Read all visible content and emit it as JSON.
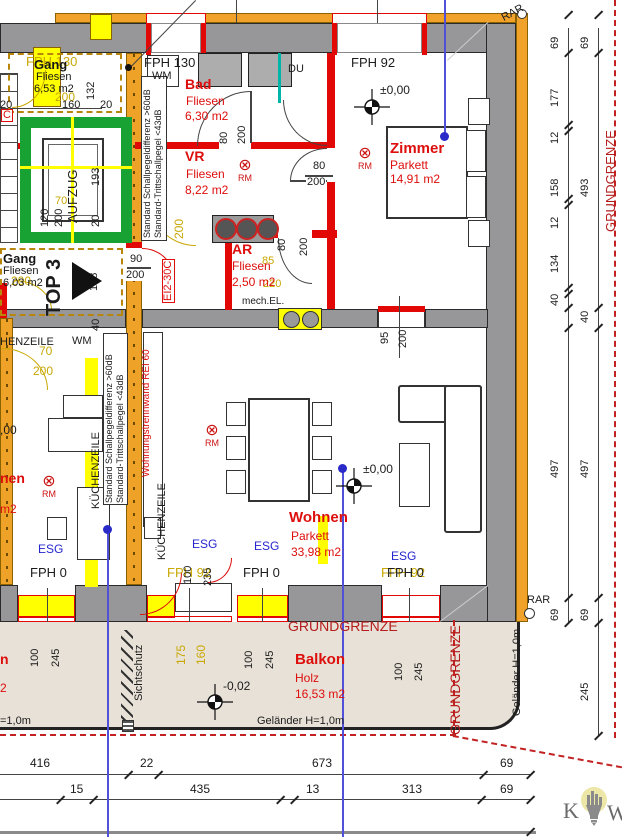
{
  "colors": {
    "wall_gray": "#97979a",
    "insulation_orange": "#f0a22a",
    "highlight_yellow": "#ffff00",
    "wall_red": "#e20806",
    "room_text_red": "#dd0e0c",
    "dim_yellow": "#c9a804",
    "glass_blue": "#2626cf",
    "axis_blue": "#5050d8",
    "elevator_green": "#17a233",
    "balcony_beige": "#e8e1d7",
    "boundary_red": "#b51d1d"
  },
  "rooms": [
    {
      "name": "Gang",
      "finish": "Fliesen",
      "area": "6,53 m2"
    },
    {
      "name": "Bad",
      "finish": "Fliesen",
      "area": "6,30 m2"
    },
    {
      "name": "VR",
      "finish": "Fliesen",
      "area": "8,22 m2"
    },
    {
      "name": "Gang",
      "finish": "Fliesen",
      "area": "6,03 m2"
    },
    {
      "name": "AR",
      "finish": "Fliesen",
      "area": "2,50 m2"
    },
    {
      "name": "Zimmer",
      "finish": "Parkett",
      "area": "14,91 m2"
    },
    {
      "name": "Wohnen",
      "finish": "Parkett",
      "area": "33,98 m2"
    },
    {
      "name": "Balkon",
      "finish": "Holz",
      "area": "16,53 m2"
    }
  ],
  "rm": {
    "symbol": "⊗",
    "label": "RM"
  },
  "logo": {
    "left": "K",
    "right": "W"
  },
  "annotations": [
    {
      "t": "FPH 130",
      "x": 26,
      "y": 55,
      "fs": 13,
      "c": "c-yel",
      "n": "fph-label"
    },
    {
      "t": "FPH 92",
      "x": 167,
      "y": 566,
      "fs": 13,
      "c": "c-yel",
      "n": "fph-label"
    },
    {
      "t": "FPH 92",
      "x": 381,
      "y": 566,
      "fs": 13,
      "c": "c-yel",
      "n": "fph-label"
    },
    {
      "t": "200",
      "x": 55,
      "y": 91,
      "fs": 12,
      "c": "c-yel",
      "n": "dim"
    },
    {
      "t": "200",
      "x": 11,
      "y": 275,
      "fs": 12,
      "c": "c-yel",
      "n": "dim"
    },
    {
      "t": "70",
      "x": 39,
      "y": 345,
      "fs": 12,
      "c": "c-yel",
      "n": "dim"
    },
    {
      "t": "200",
      "x": 33,
      "y": 365,
      "fs": 12,
      "c": "c-yel",
      "n": "dim"
    },
    {
      "t": "200",
      "x": 173,
      "y": 239,
      "fs": 12,
      "r": -90,
      "c": "c-yel",
      "n": "dim"
    },
    {
      "t": "85",
      "x": 262,
      "y": 256,
      "fs": 11,
      "c": "c-yel",
      "n": "dim"
    },
    {
      "t": "220",
      "x": 263,
      "y": 279,
      "fs": 11,
      "c": "c-yel",
      "n": "dim"
    },
    {
      "t": "175",
      "x": 175,
      "y": 665,
      "fs": 12,
      "r": -90,
      "c": "c-yel",
      "n": "dim"
    },
    {
      "t": "160",
      "x": 195,
      "y": 665,
      "fs": 12,
      "r": -90,
      "c": "c-yel",
      "n": "dim"
    },
    {
      "t": "70",
      "x": 55,
      "y": 196,
      "fs": 11,
      "c": "c-yel",
      "n": "dim"
    },
    {
      "t": "FPH 130",
      "x": 144,
      "y": 56,
      "fs": 13,
      "n": "fph-label"
    },
    {
      "t": "WM",
      "x": 152,
      "y": 71,
      "fs": 11,
      "n": "washing-machine-label"
    },
    {
      "t": "FPH 92",
      "x": 351,
      "y": 56,
      "fs": 13,
      "n": "fph-label"
    },
    {
      "t": "DU",
      "x": 288,
      "y": 64,
      "fs": 11,
      "n": "shower-label"
    },
    {
      "t": "mech.EL.",
      "x": 242,
      "y": 297,
      "fs": 10,
      "n": "mech-vent-label"
    },
    {
      "t": "WM",
      "x": 72,
      "y": 336,
      "fs": 11,
      "n": "washing-machine-label"
    },
    {
      "t": "HENZEILE",
      "x": 0,
      "y": 337,
      "fs": 11,
      "n": "kitchen-label"
    },
    {
      "t": "KÜCHENZEILE",
      "x": 91,
      "y": 509,
      "fs": 11,
      "r": -90,
      "n": "kitchen-label"
    },
    {
      "t": "KÜCHENZEILE",
      "x": 157,
      "y": 560,
      "fs": 11,
      "r": -90,
      "n": "kitchen-label"
    },
    {
      "t": "AUFZUG",
      "x": 66,
      "y": 223,
      "fs": 13,
      "r": -90,
      "n": "elevator-label"
    },
    {
      "t": "TOP 3",
      "x": 44,
      "y": 316,
      "fs": 20,
      "r": -90,
      "b": 1,
      "n": "unit-number-label"
    },
    {
      "t": "Sichtschutz",
      "x": 134,
      "y": 701,
      "fs": 11,
      "r": -90,
      "n": "privacy-screen-label"
    },
    {
      "t": "Geländer H=1,0m",
      "x": 257,
      "y": 716,
      "fs": 11,
      "n": "railing-label"
    },
    {
      "t": "=1,0m",
      "x": 0,
      "y": 716,
      "fs": 11,
      "n": "railing-label"
    },
    {
      "t": "Geländer H=1,0m",
      "x": 512,
      "y": 716,
      "fs": 11,
      "r": -90,
      "n": "railing-label"
    },
    {
      "t": "RAR",
      "x": 500,
      "y": 14,
      "fs": 11,
      "r": -28,
      "n": "rar-label"
    },
    {
      "t": "RAR",
      "x": 527,
      "y": 595,
      "fs": 11,
      "n": "rar-label"
    },
    {
      "t": "FPH 0",
      "x": 30,
      "y": 566,
      "fs": 13,
      "n": "fph-label"
    },
    {
      "t": "FPH 0",
      "x": 243,
      "y": 566,
      "fs": 13,
      "n": "fph-label"
    },
    {
      "t": "FPH 0",
      "x": 387,
      "y": 566,
      "fs": 13,
      "n": "fph-label"
    },
    {
      "t": "±0,00",
      "x": 380,
      "y": 84,
      "fs": 12,
      "n": "level-label"
    },
    {
      "t": "±0,00",
      "x": 363,
      "y": 463,
      "fs": 12,
      "n": "level-label"
    },
    {
      "t": ",00",
      "x": 0,
      "y": 424,
      "fs": 12,
      "n": "level-label"
    },
    {
      "t": "-0,02",
      "x": 223,
      "y": 680,
      "fs": 12,
      "n": "level-label"
    },
    {
      "t": "GRUNDGRENZE",
      "x": 288,
      "y": 619,
      "fs": 14,
      "c": "c-dred",
      "n": "property-line-label"
    },
    {
      "t": "GRUNDGRENZE",
      "x": 448,
      "y": 735,
      "fs": 14,
      "r": -90,
      "c": "c-dred",
      "n": "property-line-label"
    },
    {
      "t": "GRUNDGRENZE",
      "x": 604,
      "y": 232,
      "fs": 13,
      "r": -90,
      "c": "c-dred",
      "n": "property-line-label"
    },
    {
      "t": "EI2-30C",
      "x": 162,
      "y": 303,
      "fs": 11,
      "r": -90,
      "c": "c-red box",
      "n": "fire-door-label"
    },
    {
      "t": "C",
      "x": 1,
      "y": 109,
      "fs": 11,
      "c": "c-red box",
      "n": "fire-door-label"
    },
    {
      "t": "Wohnungstrennwand REI 60",
      "x": 142,
      "y": 477,
      "fs": 10,
      "r": -90,
      "c": "c-red",
      "n": "party-wall-label"
    },
    {
      "t": "nen",
      "x": 0,
      "y": 471,
      "fs": 14,
      "b": 1,
      "c": "c-red",
      "n": "room-label-partial"
    },
    {
      "t": "m2",
      "x": 0,
      "y": 503,
      "fs": 12,
      "c": "c-red",
      "n": "room-label-partial"
    },
    {
      "t": "n",
      "x": 0,
      "y": 652,
      "fs": 14,
      "b": 1,
      "c": "c-red",
      "n": "room-label-partial"
    },
    {
      "t": "2",
      "x": 0,
      "y": 682,
      "fs": 12,
      "c": "c-red",
      "n": "room-label-partial"
    },
    {
      "t": "Standard Schallpegeldifferenz >60dB",
      "x": 143,
      "y": 238,
      "fs": 9,
      "r": -90,
      "n": "sound-insulation-note"
    },
    {
      "t": "Standard-Trittschallpegel <43dB",
      "x": 154,
      "y": 238,
      "fs": 9,
      "r": -90,
      "n": "sound-insulation-note"
    },
    {
      "t": "Standard Schallpegeldifferenz >60dB",
      "x": 105,
      "y": 503,
      "fs": 9,
      "r": -90,
      "n": "sound-insulation-note"
    },
    {
      "t": "Standard-Trittschallpegel <43dB",
      "x": 116,
      "y": 503,
      "fs": 9,
      "r": -90,
      "n": "sound-insulation-note"
    },
    {
      "t": "ESG",
      "x": 192,
      "y": 538,
      "fs": 12,
      "c": "c-blu",
      "n": "glass-label"
    },
    {
      "t": "ESG",
      "x": 254,
      "y": 540,
      "fs": 12,
      "c": "c-blu",
      "n": "glass-label"
    },
    {
      "t": "ESG",
      "x": 391,
      "y": 550,
      "fs": 12,
      "c": "c-blu",
      "n": "glass-label"
    },
    {
      "t": "ESG",
      "x": 38,
      "y": 543,
      "fs": 12,
      "c": "c-blu",
      "n": "glass-label"
    },
    {
      "t": "132",
      "x": 86,
      "y": 100,
      "fs": 11,
      "r": -90,
      "n": "dim"
    },
    {
      "t": "160",
      "x": 62,
      "y": 100,
      "fs": 11,
      "n": "dim"
    },
    {
      "t": "20",
      "x": 0,
      "y": 100,
      "fs": 11,
      "n": "dim"
    },
    {
      "t": "20",
      "x": 100,
      "y": 100,
      "fs": 11,
      "n": "dim"
    },
    {
      "t": "193",
      "x": 91,
      "y": 186,
      "fs": 11,
      "r": -90,
      "n": "dim"
    },
    {
      "t": "120",
      "x": 40,
      "y": 227,
      "fs": 11,
      "r": -90,
      "n": "dim"
    },
    {
      "t": "200",
      "x": 54,
      "y": 227,
      "fs": 11,
      "r": -90,
      "n": "dim"
    },
    {
      "t": "20",
      "x": 91,
      "y": 227,
      "fs": 11,
      "r": -90,
      "n": "dim"
    },
    {
      "t": "128",
      "x": 89,
      "y": 291,
      "fs": 11,
      "r": -90,
      "n": "dim"
    },
    {
      "t": "40",
      "x": 91,
      "y": 331,
      "fs": 11,
      "r": -90,
      "n": "dim"
    },
    {
      "t": "90",
      "x": 129,
      "y": 254,
      "fs": 11,
      "c": "c-blk wbg",
      "n": "dim"
    },
    {
      "t": "200",
      "x": 125,
      "y": 270,
      "fs": 11,
      "c": "c-blk wbg",
      "n": "dim"
    },
    {
      "t": "80",
      "x": 219,
      "y": 144,
      "fs": 11,
      "r": -90,
      "n": "dim"
    },
    {
      "t": "200",
      "x": 237,
      "y": 144,
      "fs": 11,
      "r": -90,
      "n": "dim"
    },
    {
      "t": "80",
      "x": 312,
      "y": 161,
      "fs": 11,
      "c": "c-blk wbg",
      "n": "dim"
    },
    {
      "t": "200",
      "x": 306,
      "y": 177,
      "fs": 11,
      "c": "c-blk wbg",
      "n": "dim"
    },
    {
      "t": "80",
      "x": 277,
      "y": 251,
      "fs": 11,
      "r": -90,
      "n": "dim"
    },
    {
      "t": "200",
      "x": 299,
      "y": 256,
      "fs": 11,
      "r": -90,
      "n": "dim"
    },
    {
      "t": "95",
      "x": 380,
      "y": 344,
      "fs": 11,
      "r": -90,
      "n": "dim"
    },
    {
      "t": "200",
      "x": 398,
      "y": 348,
      "fs": 11,
      "r": -90,
      "n": "dim"
    },
    {
      "t": "100",
      "x": 183,
      "y": 584,
      "fs": 11,
      "r": -90,
      "n": "dim"
    },
    {
      "t": "235",
      "x": 203,
      "y": 586,
      "fs": 11,
      "r": -90,
      "n": "dim"
    },
    {
      "t": "100",
      "x": 30,
      "y": 667,
      "fs": 11,
      "r": -90,
      "n": "dim"
    },
    {
      "t": "245",
      "x": 51,
      "y": 667,
      "fs": 11,
      "r": -90,
      "n": "dim"
    },
    {
      "t": "100",
      "x": 244,
      "y": 669,
      "fs": 11,
      "r": -90,
      "n": "dim"
    },
    {
      "t": "245",
      "x": 265,
      "y": 669,
      "fs": 11,
      "r": -90,
      "n": "dim"
    },
    {
      "t": "100",
      "x": 394,
      "y": 681,
      "fs": 11,
      "r": -90,
      "n": "dim"
    },
    {
      "t": "245",
      "x": 414,
      "y": 681,
      "fs": 11,
      "r": -90,
      "n": "dim"
    },
    {
      "t": "69",
      "x": 550,
      "y": 49,
      "fs": 11,
      "r": -90,
      "n": "dim"
    },
    {
      "t": "177",
      "x": 550,
      "y": 107,
      "fs": 11,
      "r": -90,
      "n": "dim"
    },
    {
      "t": "12",
      "x": 550,
      "y": 144,
      "fs": 11,
      "r": -90,
      "n": "dim"
    },
    {
      "t": "158",
      "x": 550,
      "y": 197,
      "fs": 11,
      "r": -90,
      "n": "dim"
    },
    {
      "t": "12",
      "x": 550,
      "y": 229,
      "fs": 11,
      "r": -90,
      "n": "dim"
    },
    {
      "t": "134",
      "x": 550,
      "y": 273,
      "fs": 11,
      "r": -90,
      "n": "dim"
    },
    {
      "t": "40",
      "x": 550,
      "y": 306,
      "fs": 11,
      "r": -90,
      "n": "dim"
    },
    {
      "t": "497",
      "x": 550,
      "y": 478,
      "fs": 11,
      "r": -90,
      "n": "dim"
    },
    {
      "t": "69",
      "x": 550,
      "y": 621,
      "fs": 11,
      "r": -90,
      "n": "dim"
    },
    {
      "t": "69",
      "x": 580,
      "y": 49,
      "fs": 11,
      "r": -90,
      "n": "dim"
    },
    {
      "t": "493",
      "x": 580,
      "y": 197,
      "fs": 11,
      "r": -90,
      "n": "dim"
    },
    {
      "t": "40",
      "x": 580,
      "y": 323,
      "fs": 11,
      "r": -90,
      "n": "dim"
    },
    {
      "t": "497",
      "x": 580,
      "y": 478,
      "fs": 11,
      "r": -90,
      "n": "dim"
    },
    {
      "t": "69",
      "x": 580,
      "y": 621,
      "fs": 11,
      "r": -90,
      "n": "dim"
    },
    {
      "t": "245",
      "x": 580,
      "y": 701,
      "fs": 11,
      "r": -90,
      "n": "dim"
    },
    {
      "t": "416",
      "x": 30,
      "y": 757,
      "fs": 12,
      "n": "dim"
    },
    {
      "t": "22",
      "x": 140,
      "y": 757,
      "fs": 12,
      "n": "dim"
    },
    {
      "t": "673",
      "x": 312,
      "y": 757,
      "fs": 12,
      "n": "dim"
    },
    {
      "t": "69",
      "x": 500,
      "y": 757,
      "fs": 12,
      "n": "dim"
    },
    {
      "t": "15",
      "x": 70,
      "y": 783,
      "fs": 12,
      "n": "dim"
    },
    {
      "t": "435",
      "x": 190,
      "y": 783,
      "fs": 12,
      "n": "dim"
    },
    {
      "t": "13",
      "x": 306,
      "y": 783,
      "fs": 12,
      "n": "dim"
    },
    {
      "t": "313",
      "x": 402,
      "y": 783,
      "fs": 12,
      "n": "dim"
    },
    {
      "t": "69",
      "x": 500,
      "y": 783,
      "fs": 12,
      "n": "dim"
    }
  ]
}
